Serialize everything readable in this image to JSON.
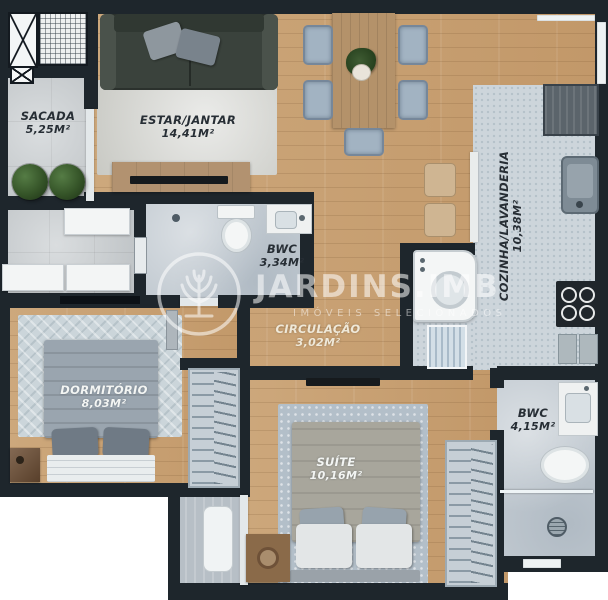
{
  "palette": {
    "wall": "#1e262c",
    "wood_floor": "#c89f73",
    "kitchen_tile": "#cdd5db",
    "balcony_tile": "#c6cbce",
    "label_dark": "#272e35",
    "label_light": "#f3f5f3",
    "watermark": "rgba(255,255,255,0.55)"
  },
  "rooms": [
    {
      "id": "sacada",
      "name": "SACADA",
      "area": "5,25M²"
    },
    {
      "id": "estar_jantar",
      "name": "ESTAR/JANTAR",
      "area": "14,41M²"
    },
    {
      "id": "bwc_social",
      "name": "BWC",
      "area": "3,34M²"
    },
    {
      "id": "cozinha_lavanderia",
      "name": "COZINHA/LAVANDERIA",
      "area": "10,38M²"
    },
    {
      "id": "circulacao",
      "name": "CIRCULAÇÃO",
      "area": "3,02M²"
    },
    {
      "id": "dormitorio",
      "name": "DORMITÓRIO",
      "area": "8,03M²"
    },
    {
      "id": "suite",
      "name": "SUÍTE",
      "area": "10,16M²"
    },
    {
      "id": "bwc_suite",
      "name": "BWC",
      "area": "4,15M²"
    }
  ],
  "watermark": {
    "brand": "JARDINS.IMB",
    "tagline": "IMÓVEIS SELECIONADOS"
  }
}
